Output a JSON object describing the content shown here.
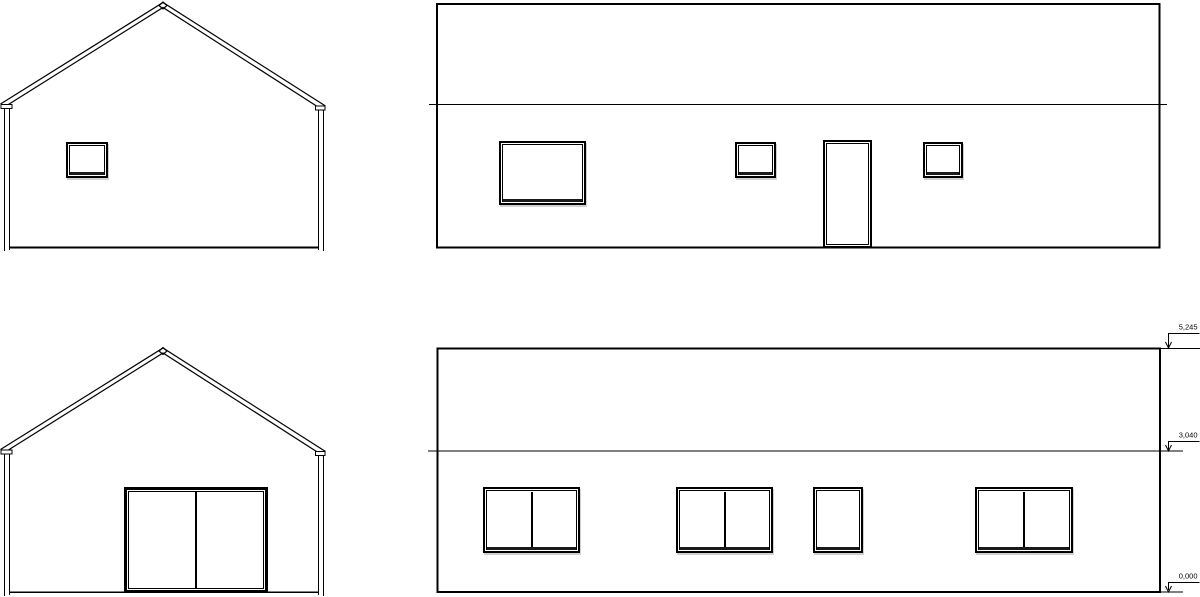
{
  "drawing": {
    "background_color": "#ffffff",
    "line_color": "#000000",
    "levels": {
      "ridge": "5,245",
      "eave": "3,040",
      "ground": "0,000"
    }
  }
}
